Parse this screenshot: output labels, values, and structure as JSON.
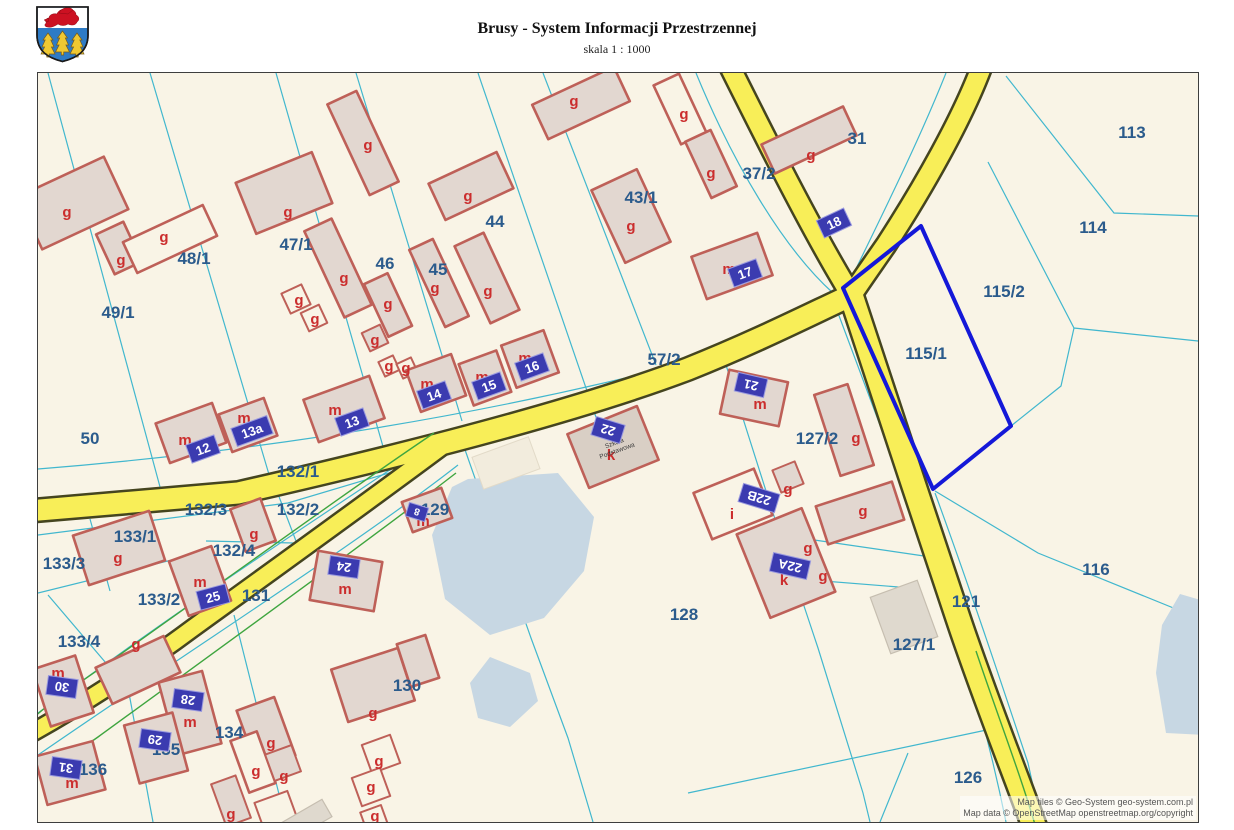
{
  "header": {
    "title": "Brusy - System Informacji Przestrzennej",
    "scale": "skala 1 : 1000"
  },
  "attribution": {
    "line1": "Map tiles © Geo-System geo-system.com.pl",
    "line2": "Map data © OpenStreetMap openstreetmap.org/copyright"
  },
  "letters": {
    "g": "g",
    "m": "m",
    "k": "k",
    "i": "i"
  },
  "school": {
    "line1": "Szkoła",
    "line2": "Podstawowa"
  },
  "parcels": {
    "48_1": "48/1",
    "49_1": "49/1",
    "47_1": "47/1",
    "46": "46",
    "45": "45",
    "44": "44",
    "43_1": "43/1",
    "37_2": "37/2",
    "31": "31",
    "113": "113",
    "114": "114",
    "115_2": "115/2",
    "115_1": "115/1",
    "57_2": "57/2",
    "50": "50",
    "132_1": "132/1",
    "132_3": "132/3",
    "132_2": "132/2",
    "133_1": "133/1",
    "133_3": "133/3",
    "132_4": "132/4",
    "133_2": "133/2",
    "131": "131",
    "129": "129",
    "127_2": "127/2",
    "128": "128",
    "127_1": "127/1",
    "121": "121",
    "116": "116",
    "126": "126",
    "133_4": "133/4",
    "134": "134",
    "135": "135",
    "136": "136",
    "130": "130"
  },
  "addresses": {
    "n12": "12",
    "n13": "13",
    "n13a": "13a",
    "n14": "14",
    "n15": "15",
    "n16": "16",
    "n17": "17",
    "n18": "18",
    "n21": "21",
    "n22": "22",
    "n22A": "22A",
    "n22B": "22B",
    "n24": "24",
    "n25": "25",
    "n8": "8",
    "n28": "28",
    "n29": "29",
    "n30": "30",
    "n31": "31"
  },
  "colors": {
    "highlight": "#1418D8",
    "road": "#F8EE58",
    "parcel_line": "#41B7CE",
    "building_outline": "#BE6058",
    "plate": "#3B3BB0",
    "water": "#C7D7E3"
  }
}
